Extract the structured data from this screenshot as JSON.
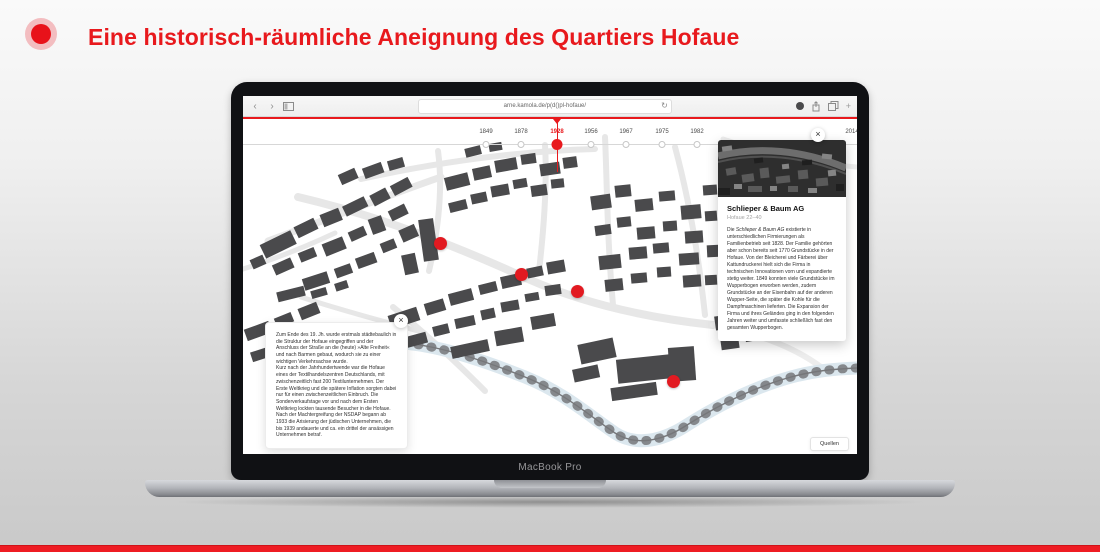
{
  "header": {
    "title": "Eine historisch-räumliche Aneignung des Quartiers Hofaue",
    "accent_color": "#e8191d"
  },
  "laptop": {
    "label": "MacBook Pro"
  },
  "browser": {
    "url": "arne.kamola.de/p(d()pl-hofaue/",
    "back_label": "‹",
    "forward_label": "›",
    "refresh_label": "↻",
    "new_tab_label": "+"
  },
  "timeline": {
    "years": [
      {
        "label": "1849",
        "selected": false
      },
      {
        "label": "1878",
        "selected": false
      },
      {
        "label": "1928",
        "selected": true
      },
      {
        "label": "1956",
        "selected": false
      },
      {
        "label": "1967",
        "selected": false
      },
      {
        "label": "1975",
        "selected": false
      },
      {
        "label": "1982",
        "selected": false
      },
      {
        "label": "2014",
        "selected": false
      }
    ],
    "selected_year": "1928"
  },
  "info_box": {
    "paragraphs": [
      "Zum Ende des 19. Jh. wurde erstmals städtebaulich in die Struktur der Hofaue eingegriffen und der Anschluss der Straße an die (heute) »Alte Freiheit« und nach Barmen gebaut, wodurch sie zu einer wichtigen Verkehrsachse wurde.",
      "Kurz nach der Jahrhundertwende war die Hofaue eines der Textilhandelszentren Deutschlands, mit zwischenzeitlich fast 200 Textilunternehmen. Der Erste Weltkrieg und die spätere Inflation sorgten dabei nur für einen zwischenzeitlichen Einbruch. Die Sonderverkaufstage vor und nach dem Ersten Weltkrieg lockten tausende Besucher in die Hofaue.",
      "Nach der Machtergreifung der NSDAP begann ab 1933 die Arisierung der jüdischen Unternehmen, die bis 1939 andauerte und ca. ein drittel der ansässigen Unternehmen betraf."
    ],
    "close_label": "×"
  },
  "detail_panel": {
    "title": "Schlieper & Baum AG",
    "subtitle": "Hofaue 22–40",
    "body_lead": "Die ",
    "body_company": "Schlieper & Baum AG",
    "body_rest": " existierte in unterschiedlichen Firmierungen als Familienbetrieb seit 1828. Der Familie gehörten aber schon bereits seit 1770 Grundstücke in der Hofaue. Von der Bleicherei und Färberei über Kattundruckerei hielt sich die Firma in technischen Innovationen vorn und expandierte stetig weiter. 1849 konnten viele Grundstücke im Wupperbogen erworben werden, zudem Grundstücke an der Eisenbahn auf der anderen Wupper-Seite, die später die Kohle für die Dampfmaschinen lieferten. Die Expansion der Firma und ihres Geländes ging in den folgenden Jahren weiter und umfasste schließlich fast den gesamten Wupperbogen.",
    "close_label": "×"
  },
  "buttons": {
    "sources_label": "Quellen"
  },
  "map": {
    "marker_color": "#e21a21",
    "building_color": "#4a4a4c",
    "river_color": "#dbe7ee",
    "marker_count": 4
  }
}
